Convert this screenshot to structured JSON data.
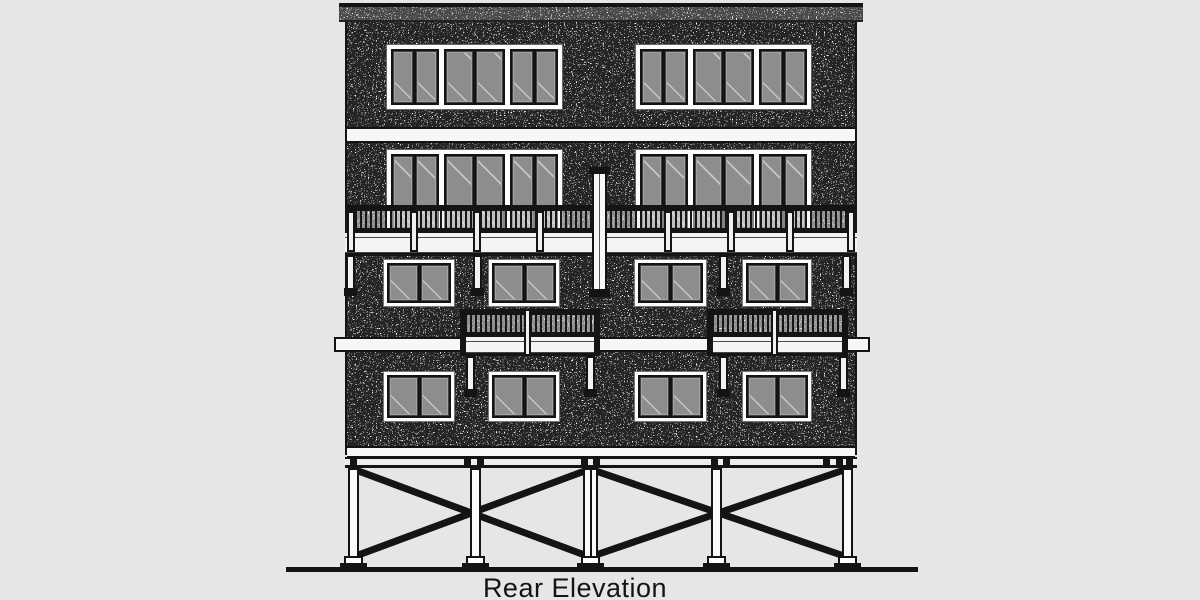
{
  "drawing": {
    "title": "Rear Elevation"
  },
  "palette": {
    "page_background": "#e6e6e6",
    "ink": "#141414",
    "wall_white": "#fcfcfc",
    "glass_gray": "#8d8d8d",
    "band_white": "#f7f7f7"
  },
  "structure": {
    "floors": 4,
    "top_floor_window_groups": 2,
    "windows_per_group": 3,
    "panes_per_window": 2,
    "third_floor_door_groups": 2,
    "second_floor_windows": 4,
    "first_floor_windows": 4,
    "full_width_deck_railings": 1,
    "small_balconies": 2,
    "center_flue_posts": 1,
    "piling_posts": 5,
    "cross_braces": 2
  }
}
